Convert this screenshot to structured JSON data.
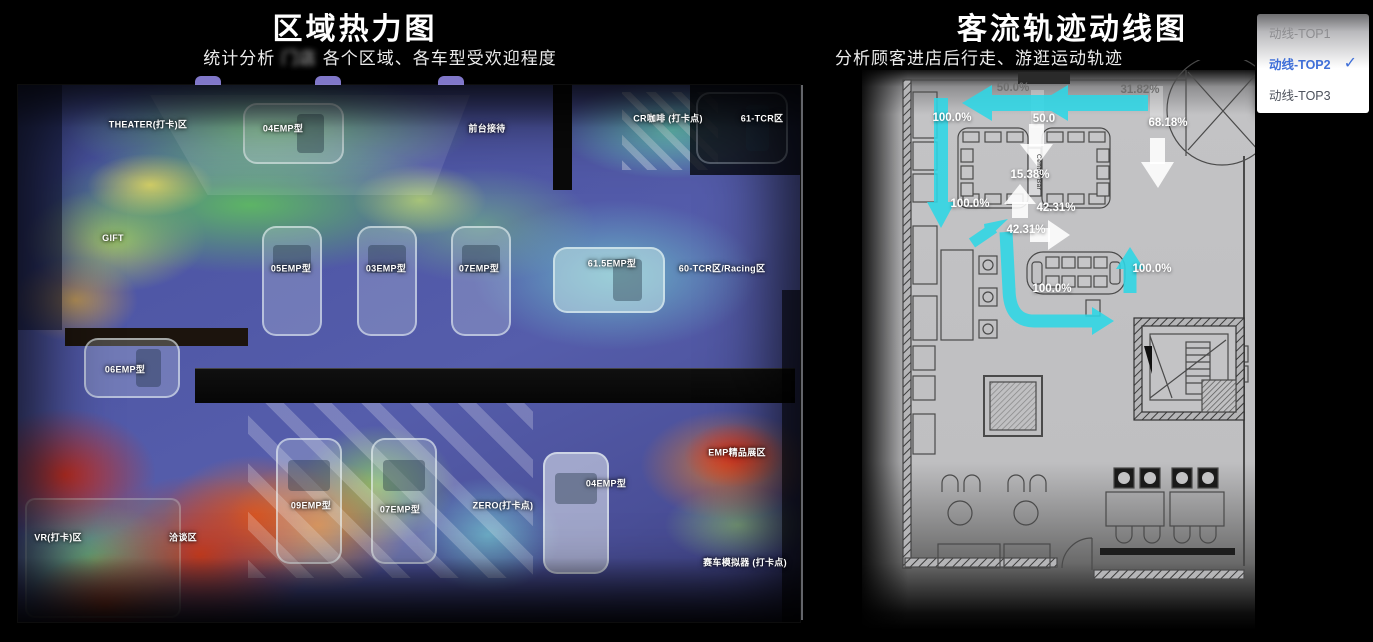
{
  "left_panel": {
    "title": "区域热力图",
    "subtitle_prefix": "统计分析",
    "subtitle_blur": "门店",
    "subtitle_suffix": "各个区域、各车型受欢迎程度",
    "area_labels": [
      {
        "text": "THEATER(打卡)区",
        "x": 148,
        "y": 124
      },
      {
        "text": "前台接待",
        "x": 487,
        "y": 128
      },
      {
        "text": "04EMP型",
        "x": 283,
        "y": 128
      },
      {
        "text": "CR咖啡 (打卡点)",
        "x": 668,
        "y": 118
      },
      {
        "text": "61-TCR区",
        "x": 762,
        "y": 118
      },
      {
        "text": "GIFT",
        "x": 113,
        "y": 238
      },
      {
        "text": "05EMP型",
        "x": 291,
        "y": 268
      },
      {
        "text": "03EMP型",
        "x": 386,
        "y": 268
      },
      {
        "text": "07EMP型",
        "x": 479,
        "y": 268
      },
      {
        "text": "61.5EMP型",
        "x": 612,
        "y": 263
      },
      {
        "text": "60-TCR区/Racing区",
        "x": 722,
        "y": 268
      },
      {
        "text": "06EMP型",
        "x": 125,
        "y": 369
      },
      {
        "text": "EMP精品展区",
        "x": 737,
        "y": 452
      },
      {
        "text": "VR(打卡)区",
        "x": 58,
        "y": 537
      },
      {
        "text": "洽谈区",
        "x": 183,
        "y": 537
      },
      {
        "text": "09EMP型",
        "x": 311,
        "y": 505
      },
      {
        "text": "07EMP型",
        "x": 400,
        "y": 509
      },
      {
        "text": "ZERO(打卡点)",
        "x": 503,
        "y": 505
      },
      {
        "text": "04EMP型",
        "x": 606,
        "y": 483
      },
      {
        "text": "赛车模拟器 (打卡点)",
        "x": 745,
        "y": 562
      }
    ]
  },
  "right_panel": {
    "title": "客流轨迹动线图",
    "subtitle": "分析顾客进店后行走、游逛运动轨迹",
    "center_bar_label": "Center Bar",
    "flow_labels": [
      {
        "text": "50.0%",
        "x": 1013,
        "y": 88,
        "muted": true
      },
      {
        "text": "31.82%",
        "x": 1140,
        "y": 90,
        "muted": true
      },
      {
        "text": "100.0%",
        "x": 952,
        "y": 118
      },
      {
        "text": "50.0",
        "x": 1044,
        "y": 119
      },
      {
        "text": "68.18%",
        "x": 1168,
        "y": 123
      },
      {
        "text": "15.38%",
        "x": 1030,
        "y": 175
      },
      {
        "text": "100.0%",
        "x": 970,
        "y": 204
      },
      {
        "text": "42.31%",
        "x": 1056,
        "y": 208
      },
      {
        "text": "42.31%",
        "x": 1026,
        "y": 230
      },
      {
        "text": "100.0%",
        "x": 1152,
        "y": 269
      },
      {
        "text": "100.0%",
        "x": 1052,
        "y": 289
      }
    ]
  },
  "dropdown": {
    "check_icon": "✓",
    "items": [
      {
        "label": "动线-TOP1",
        "selected": false
      },
      {
        "label": "动线-TOP2",
        "selected": true
      },
      {
        "label": "动线-TOP3",
        "selected": false
      }
    ]
  },
  "colors": {
    "flow_cyan": "#2ed7e6",
    "accent_blue": "#3f6fd8",
    "heat_high": "#c62f20",
    "heat_mid": "#59b15f",
    "heat_low": "#4a55a3"
  },
  "chart_data": [
    {
      "type": "heatmap",
      "title": "区域热力图",
      "subtitle": "统计分析门店各个区域、各车型受欢迎程度",
      "legend_note": "红=受欢迎程度高, 黄/绿=中, 蓝/紫=低",
      "zones": [
        {
          "name": "THEATER(打卡)区",
          "intensity": "medium-high"
        },
        {
          "name": "GIFT",
          "intensity": "medium"
        },
        {
          "name": "前台接待",
          "intensity": "medium"
        },
        {
          "name": "04EMP型",
          "intensity": "medium"
        },
        {
          "name": "05EMP型",
          "intensity": "medium"
        },
        {
          "name": "03EMP型",
          "intensity": "medium"
        },
        {
          "name": "07EMP型",
          "intensity": "medium"
        },
        {
          "name": "61.5EMP型",
          "intensity": "low"
        },
        {
          "name": "CR咖啡 (打卡点)",
          "intensity": "low"
        },
        {
          "name": "61-TCR区",
          "intensity": "low"
        },
        {
          "name": "60-TCR区/Racing区",
          "intensity": "low"
        },
        {
          "name": "06EMP型",
          "intensity": "medium"
        },
        {
          "name": "VR(打卡)区",
          "intensity": "high"
        },
        {
          "name": "洽谈区",
          "intensity": "high"
        },
        {
          "name": "09EMP型",
          "intensity": "high"
        },
        {
          "name": "ZERO(打卡点)",
          "intensity": "medium-low"
        },
        {
          "name": "04EMP型(下排)",
          "intensity": "low"
        },
        {
          "name": "EMP精品展区",
          "intensity": "high"
        },
        {
          "name": "赛车模拟器 (打卡点)",
          "intensity": "low"
        }
      ]
    },
    {
      "type": "flow",
      "title": "客流轨迹动线图",
      "subtitle": "分析顾客进店后行走、游逛运动轨迹",
      "selected_route": "动线-TOP2",
      "route_options": [
        "动线-TOP1",
        "动线-TOP2",
        "动线-TOP3"
      ],
      "flow_percentages": [
        50.0,
        31.82,
        100.0,
        50.0,
        68.18,
        15.38,
        100.0,
        42.31,
        42.31,
        100.0,
        100.0
      ]
    }
  ]
}
